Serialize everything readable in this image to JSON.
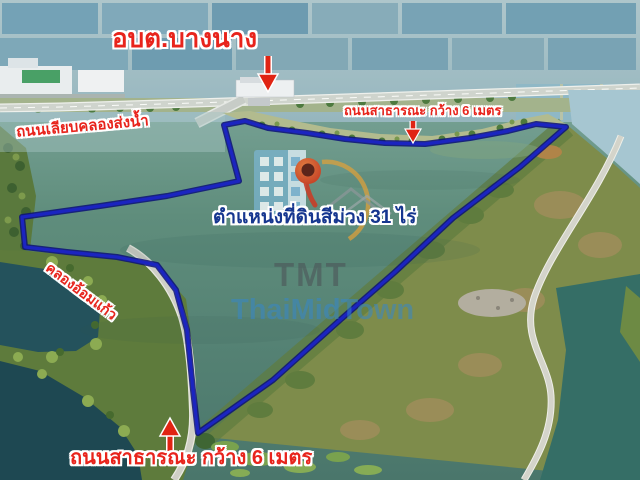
{
  "scene": {
    "description": "aerial-drone-photo-of-land-plot-for-sale",
    "labels": {
      "subdistrict_office": "อบต.บางนาง",
      "canal_side_road": "ถนนเลียบคลองส่งน้ำ",
      "public_road_top": "ถนนสาธารณะ กว้าง 6 เมตร",
      "plot_caption": "ตำแหน่งที่ดินสีม่วง 31 ไร่",
      "canal_name": "คลองอ้อมแก้ว",
      "public_road_bottom": "ถนนสาธารณะ กว้าง 6 เมตร"
    },
    "plot": {
      "area_rai": "31",
      "boundary_points": "224,125 245,121 268,128 307,133 345,139 385,143 425,144 470,138 508,131 536,124 566,127 520,167 453,218 395,272 340,320 273,380 198,433 193,390 187,330 176,290 157,265 117,257 67,252 25,247 22,217 100,206 167,196 239,181"
    },
    "watermark": {
      "initials": "TMT",
      "name": "ThaiMidTown"
    },
    "colors": {
      "boundary_blue": "#1b24c0",
      "boundary_outline": "#0b1178",
      "label_red": "#e8241c",
      "label_stroke": "#ffffff",
      "caption_blue": "#16368f",
      "arrow_red": "#e02413",
      "watermark_gray": "rgba(75,80,86,0.55)",
      "watermark_blue": "rgba(55,135,200,0.55)"
    }
  }
}
